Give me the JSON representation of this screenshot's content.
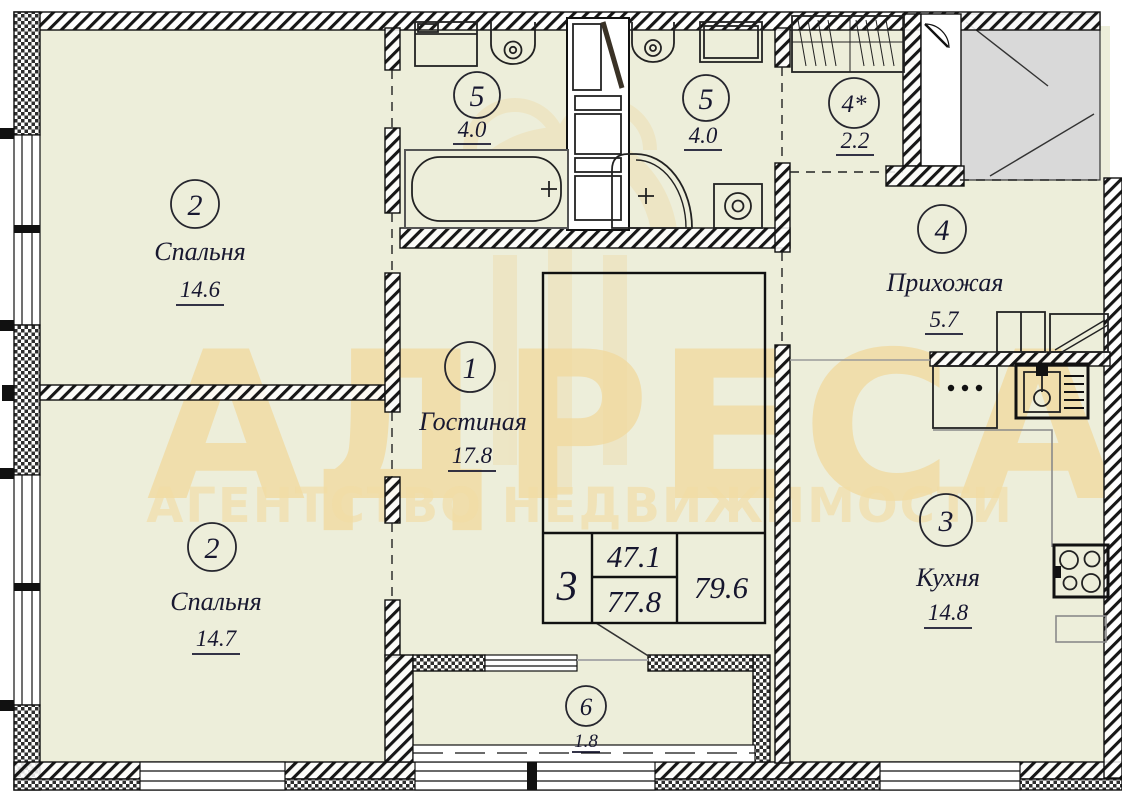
{
  "plan_title": "apartment-floor-plan",
  "watermark": {
    "brand": "АДРЕСА",
    "tagline": "АГЕНТСТВО НЕДВИЖИМОСТИ"
  },
  "rooms": [
    {
      "id": "bedroom-1",
      "number": "2",
      "name": "Спальня",
      "area": "14.6"
    },
    {
      "id": "bedroom-2",
      "number": "2",
      "name": "Спальня",
      "area": "14.7"
    },
    {
      "id": "bathroom-1",
      "number": "5",
      "name": "",
      "area": "4.0"
    },
    {
      "id": "bathroom-2",
      "number": "5",
      "name": "",
      "area": "4.0"
    },
    {
      "id": "wardrobe",
      "number": "4*",
      "name": "",
      "area": "2.2"
    },
    {
      "id": "hallway",
      "number": "4",
      "name": "Прихожая",
      "area": "5.7"
    },
    {
      "id": "living-room",
      "number": "1",
      "name": "Гостиная",
      "area": "17.8"
    },
    {
      "id": "kitchen",
      "number": "3",
      "name": "Кухня",
      "area": "14.8"
    },
    {
      "id": "balcony",
      "number": "6",
      "name": "",
      "area": "1.8"
    }
  ],
  "summary_table": {
    "rooms_count": "3",
    "living_area": "47.1",
    "floor_area": "77.8",
    "total_area": "79.6"
  },
  "colors": {
    "floor_fill": "#edeeda",
    "stairwell_fill": "#d9d9d9",
    "wall_line": "#111111",
    "watermark": "#f0d9a0",
    "label_text": "#181830"
  }
}
